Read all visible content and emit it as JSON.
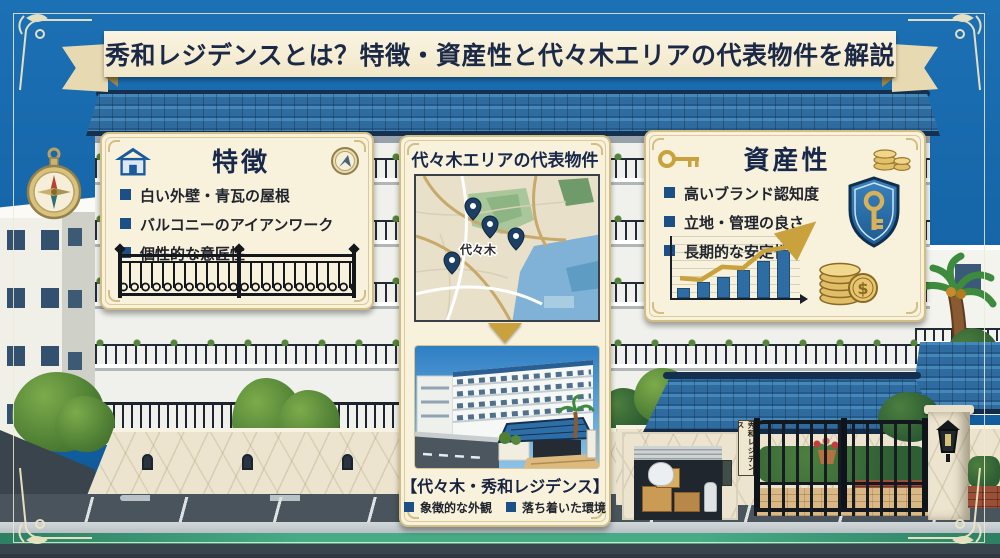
{
  "banner": {
    "title": "秀和レジデンスとは？特徴・資産性と代々木エリアの代表物件を解説"
  },
  "features_panel": {
    "heading": "特徴",
    "bullets": [
      "白い外壁・青瓦の屋根",
      "バルコニーのアイアンワーク",
      "個性的な意匠性"
    ]
  },
  "property_panel": {
    "heading": "代々木エリアの代表物件",
    "map_label": "代々木",
    "caption": "【代々木・秀和レジデンス】",
    "bullets": [
      "象徴的な外観",
      "落ち着いた環境"
    ]
  },
  "asset_panel": {
    "heading": "資産性",
    "bullets": [
      "高いブランド認知度",
      "立地・管理の良さ",
      "長期的な安定性"
    ],
    "currency_symbol": "$",
    "chart": {
      "type": "bar",
      "values": [
        16,
        26,
        34,
        45,
        60,
        78
      ],
      "bar_color": "#2e6da4",
      "trend_color": "#c9a23e",
      "note": "decorative rising bar chart, no axis labels shown"
    }
  },
  "gate": {
    "sign": "秀和レジデンス"
  },
  "colors": {
    "sky_blue": "#1565a8",
    "roof_blue": "#2f6b9e",
    "panel_cream": "#f8f1dc",
    "panel_border": "#d2be84",
    "heading_navy": "#18284a",
    "bullet_blue": "#1c4f86",
    "accent_gold": "#c9a23e",
    "bar_blue": "#2e6da4",
    "street_green": "#47ab85"
  }
}
